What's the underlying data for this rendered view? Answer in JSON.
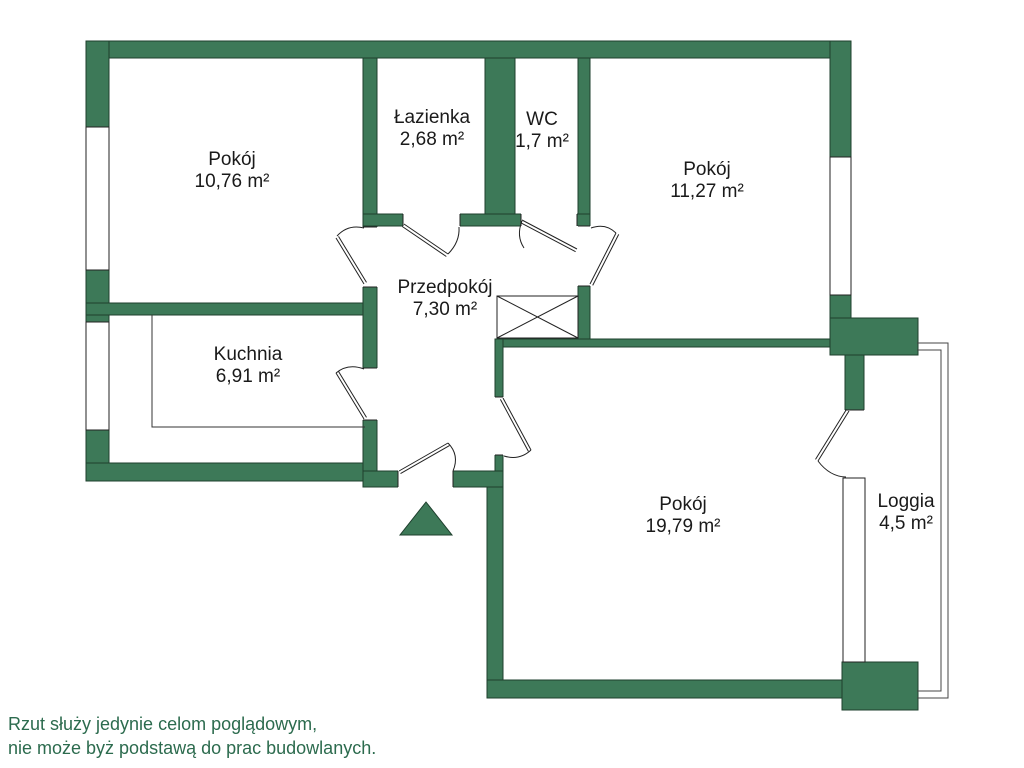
{
  "floorplan": {
    "rooms": [
      {
        "name": "Pokój",
        "area": "10,76 m²"
      },
      {
        "name": "Łazienka",
        "area": "2,68 m²"
      },
      {
        "name": "WC",
        "area": "1,7 m²"
      },
      {
        "name": "Pokój",
        "area": "11,27 m²"
      },
      {
        "name": "Przedpokój",
        "area": "7,30 m²"
      },
      {
        "name": "Kuchnia",
        "area": "6,91 m²"
      },
      {
        "name": "Pokój",
        "area": "19,79 m²"
      },
      {
        "name": "Loggia",
        "area": "4,5 m²"
      }
    ],
    "disclaimer": {
      "line1": "Rzut służy jedynie celom poglądowym,",
      "line2": "nie może byż podstawą do prac budowlanych."
    },
    "colors": {
      "wall_green": "#3d7958",
      "wall_outline": "#1e3f2d",
      "line_black": "#222222",
      "label_text": "#1a1a1a",
      "disclaimer_text": "#2c6b4e",
      "background": "#ffffff"
    },
    "symbols": {
      "entrance_arrow": "triangle-up",
      "shaft": "crossed-box"
    }
  }
}
